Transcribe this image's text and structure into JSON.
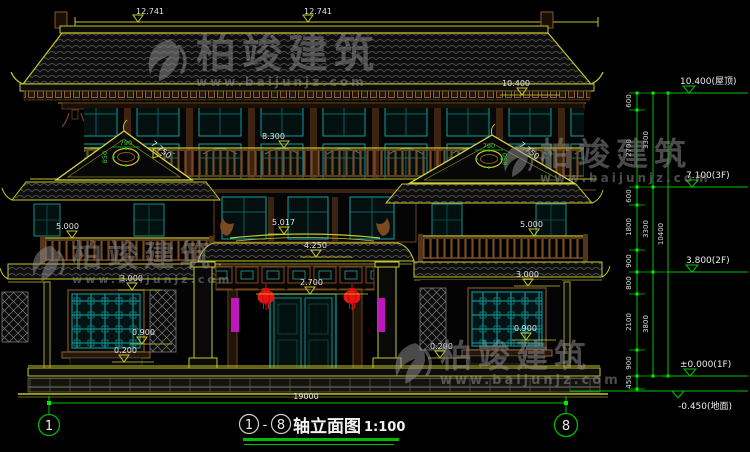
{
  "watermark": {
    "brand": "柏竣建筑",
    "url": "www.baijunjz.com"
  },
  "title_bar": {
    "axis_start": "1",
    "axis_sep": "-",
    "axis_end": "8",
    "title": "轴立面图",
    "scale": "1:100"
  },
  "axes": {
    "left": "1",
    "right": "8"
  },
  "dims": {
    "ridge_left": "12.741",
    "ridge_right": "12.741",
    "roof_eave": "10.400",
    "balcony3f": "8.300",
    "gable_slope_l": "7.750",
    "gable_slope_r": "7.750",
    "vent_w_l": "790",
    "vent_h_l": "850",
    "vent_w_r": "790",
    "vent_h_r": "850",
    "canopy_top": "5.017",
    "canopy_eave": "4.250",
    "rail_l": "5.000",
    "rail_r": "5.000",
    "door_head": "2.700",
    "win_head_l": "3.000",
    "win_head_r": "3.000",
    "sill_l": "0.900",
    "sill_r": "0.900",
    "plinth_l": "0.200",
    "plinth_r": "0.200",
    "overall": "19000"
  },
  "levels": {
    "roof": "10.400(屋顶)",
    "f3": "7.100(3F)",
    "f2": "3.800(2F)",
    "f1": "±0.000(1F)",
    "ground": "-0.450(地面)"
  },
  "chain": {
    "s600a": "600",
    "s2700": "2700",
    "s600b": "600",
    "s1800": "1800",
    "s900a": "900",
    "s800": "800",
    "s2100": "2100",
    "s900b": "900",
    "s450": "450",
    "t3300a": "3300",
    "t3300b": "3300",
    "t3800": "3800",
    "total": "10400"
  }
}
